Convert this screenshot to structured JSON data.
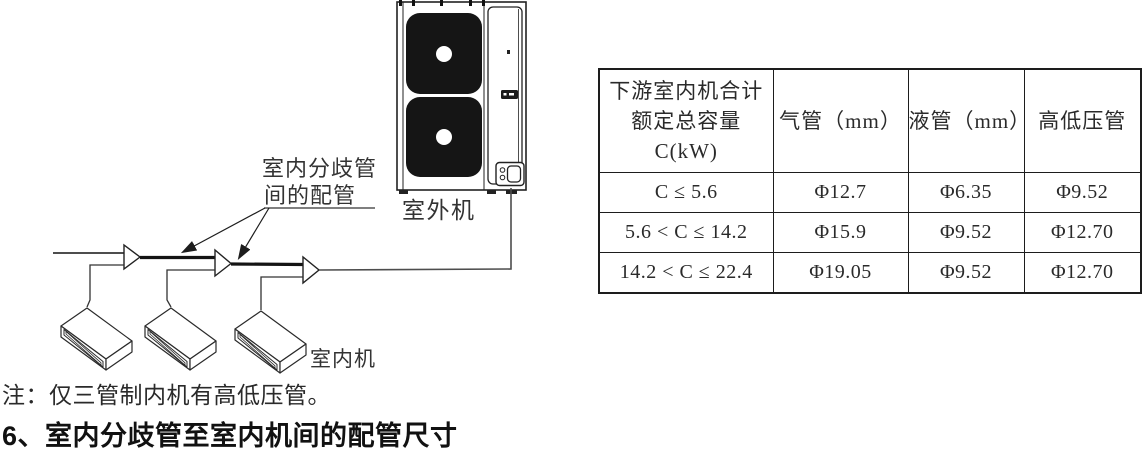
{
  "diagram": {
    "labels": {
      "branch_pipe_line1": "室内分歧管",
      "branch_pipe_line2": "间的配管",
      "outdoor_unit": "室外机",
      "indoor_unit": "室内机"
    },
    "colors": {
      "line": "#333333",
      "fan_fill": "#151515",
      "thick_pipe": "#141414"
    }
  },
  "table": {
    "headers": [
      "下游室内机合计\n额定总容量C(kW)",
      "气管（mm）",
      "液管（mm）",
      "高低压管"
    ],
    "rows": [
      [
        "C ≤ 5.6",
        "Φ12.7",
        "Φ6.35",
        "Φ9.52"
      ],
      [
        "5.6 < C ≤ 14.2",
        "Φ15.9",
        "Φ9.52",
        "Φ12.70"
      ],
      [
        "14.2 < C ≤ 22.4",
        "Φ19.05",
        "Φ9.52",
        "Φ12.70"
      ]
    ]
  },
  "note": "注：仅三管制内机有高低压管。",
  "heading": "6、室内分歧管至室内机间的配管尺寸"
}
